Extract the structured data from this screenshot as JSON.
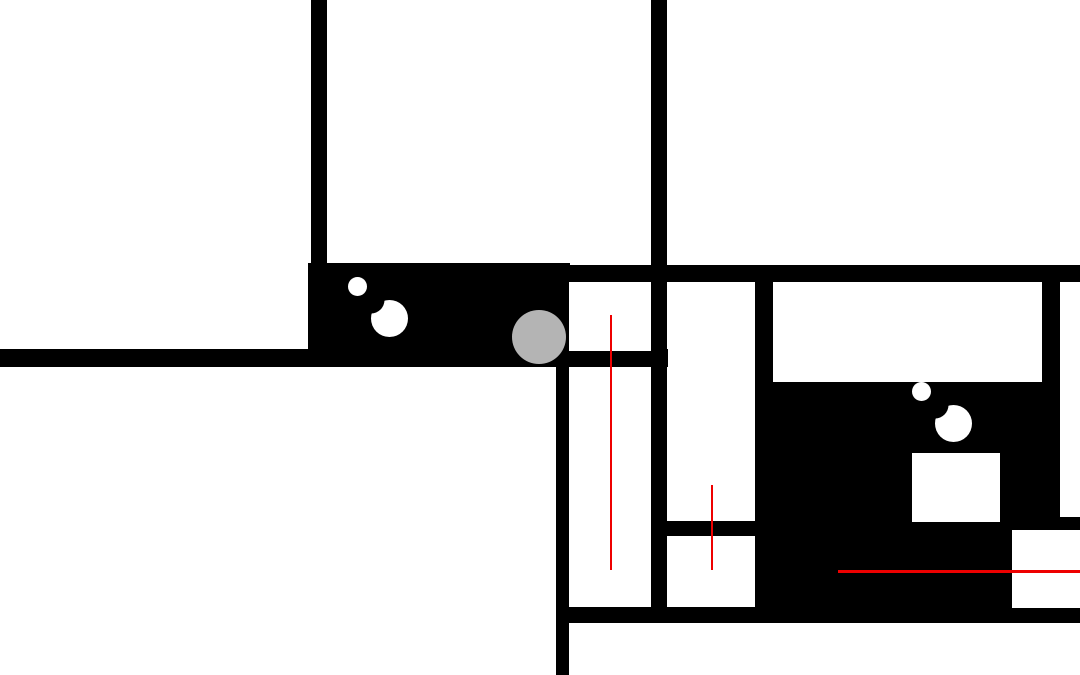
{
  "scene": {
    "title": "top-down-occupancy-map",
    "width": 1080,
    "height": 675,
    "background": "#ffffff"
  },
  "colors": {
    "wall": "#000000",
    "free_space": "#ffffff",
    "path_trace": "#ee0000",
    "agent_fill": "#b4b4b4",
    "goal_ring": "#ffffff",
    "goal_gap": "#000000"
  },
  "walls": [
    {
      "name": "wall-vertical-top-left",
      "x": 311,
      "y": 0,
      "w": 16,
      "h": 265
    },
    {
      "name": "wall-vertical-center",
      "x": 651,
      "y": 0,
      "w": 16,
      "h": 607
    },
    {
      "name": "wall-horizontal-main",
      "x": 308,
      "y": 265,
      "w": 772,
      "h": 17
    },
    {
      "name": "corridor-block",
      "x": 308,
      "y": 263,
      "w": 262,
      "h": 104
    },
    {
      "name": "wall-horizontal-left",
      "x": 0,
      "y": 349,
      "w": 668,
      "h": 18
    },
    {
      "name": "wall-vertical-left-lower",
      "x": 556,
      "y": 349,
      "w": 13,
      "h": 326
    },
    {
      "name": "wall-horizontal-bottom",
      "x": 556,
      "y": 607,
      "w": 524,
      "h": 16
    },
    {
      "name": "wall-divider-middle-rooms",
      "x": 651,
      "y": 521,
      "w": 122,
      "h": 15
    },
    {
      "name": "wall-vertical-middle-right",
      "x": 755,
      "y": 282,
      "w": 18,
      "h": 341
    },
    {
      "name": "black-field-right",
      "x": 773,
      "y": 382,
      "w": 307,
      "h": 241
    },
    {
      "name": "wall-vertical-far-right",
      "x": 1042,
      "y": 265,
      "w": 18,
      "h": 130
    }
  ],
  "rooms": [
    {
      "name": "room-left-upper",
      "x": 569,
      "y": 282,
      "w": 82,
      "h": 69
    },
    {
      "name": "room-left-lower",
      "x": 569,
      "y": 367,
      "w": 82,
      "h": 240
    },
    {
      "name": "room-middle-tall",
      "x": 668,
      "y": 282,
      "w": 87,
      "h": 239
    },
    {
      "name": "room-middle-lower",
      "x": 668,
      "y": 536,
      "w": 87,
      "h": 71
    },
    {
      "name": "room-right-wide",
      "x": 773,
      "y": 282,
      "w": 269,
      "h": 100
    },
    {
      "name": "room-far-right-column",
      "x": 1060,
      "y": 282,
      "w": 20,
      "h": 235
    },
    {
      "name": "white-box-in-field",
      "x": 912,
      "y": 453,
      "w": 88,
      "h": 69
    },
    {
      "name": "white-box-bottom-right",
      "x": 1012,
      "y": 530,
      "w": 68,
      "h": 78
    }
  ],
  "path_traces": [
    {
      "name": "path-trace-vertical-left",
      "orientation": "vertical",
      "x": 610,
      "y": 315,
      "length": 255,
      "thickness": 2
    },
    {
      "name": "path-trace-vertical-middle",
      "orientation": "vertical",
      "x": 711,
      "y": 485,
      "length": 85,
      "thickness": 2
    },
    {
      "name": "path-trace-horizontal-right",
      "orientation": "horizontal",
      "x": 838,
      "y": 570,
      "length": 242,
      "thickness": 3
    }
  ],
  "goal_markers": [
    {
      "name": "goal-bullseye-corridor",
      "cx": 389,
      "cy": 318,
      "outer_d": 37,
      "mid_d": 27,
      "core_d": 19
    },
    {
      "name": "goal-bullseye-field",
      "cx": 953,
      "cy": 423,
      "outer_d": 37,
      "mid_d": 27,
      "core_d": 19
    }
  ],
  "agent": {
    "name": "agent-circle",
    "cx": 539,
    "cy": 337,
    "d": 54
  }
}
